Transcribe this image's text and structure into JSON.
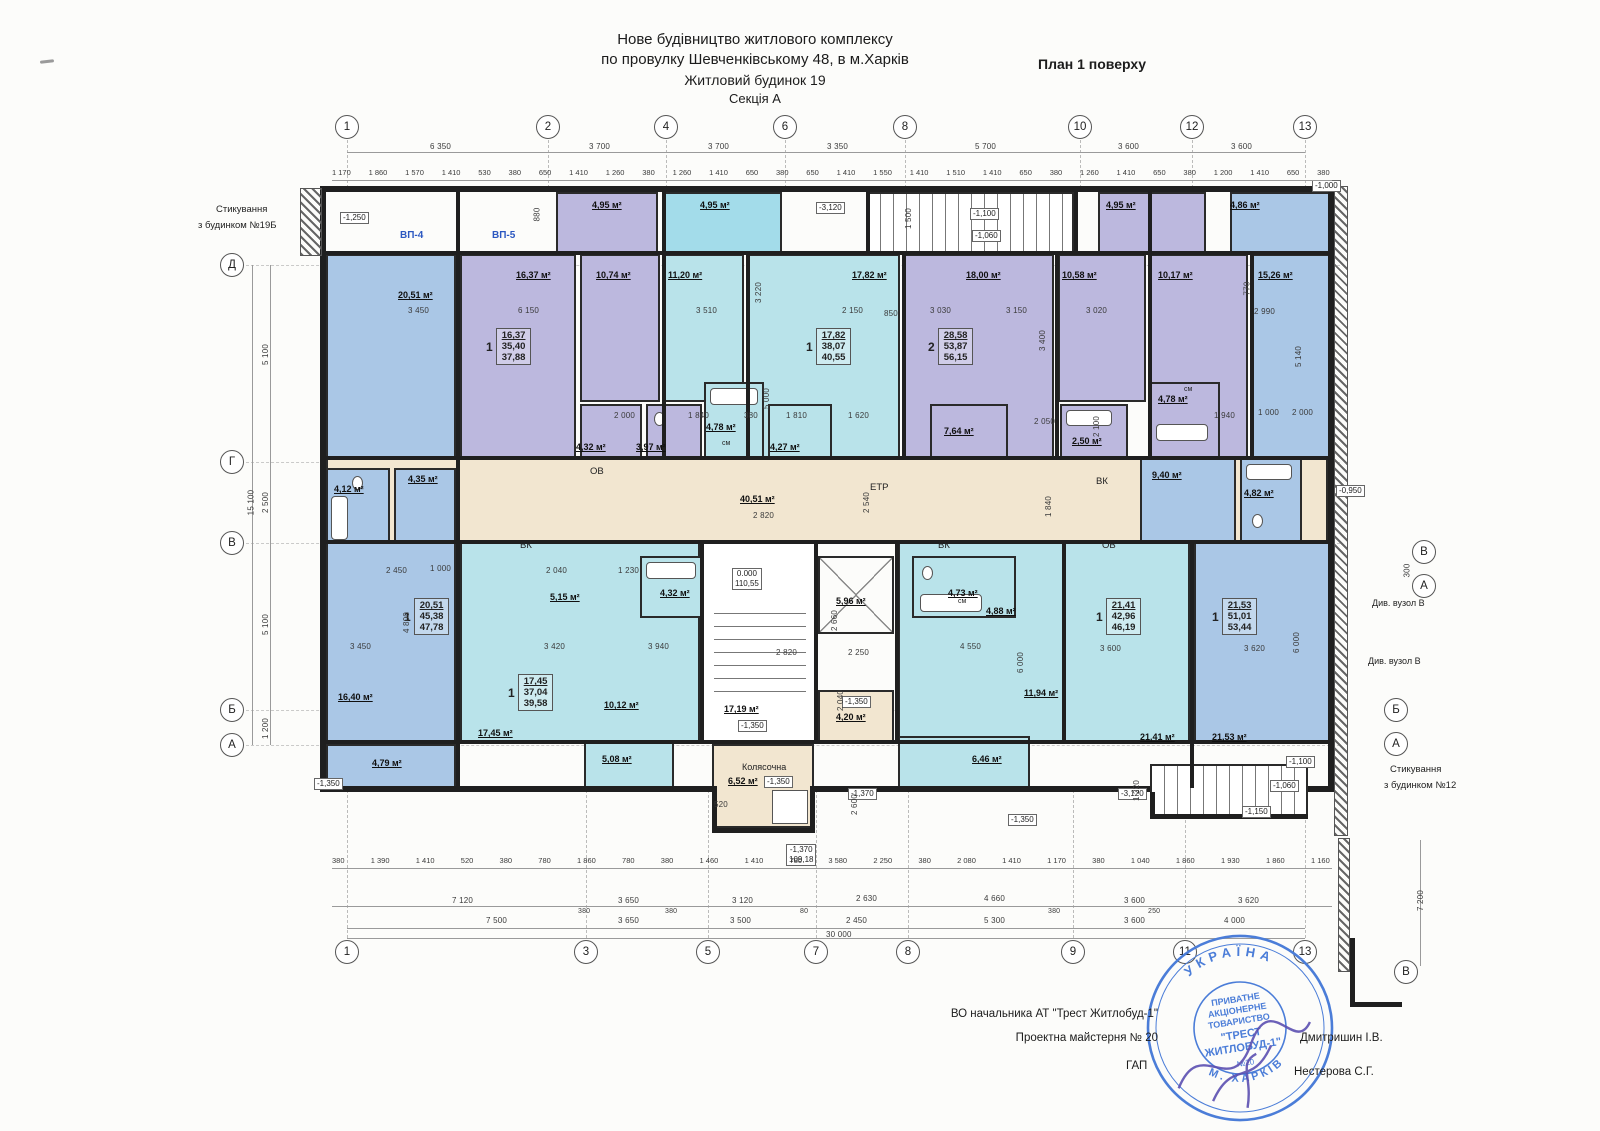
{
  "header": {
    "t1": "Нове будівництво житлового комплексу",
    "t2": "по провулку Шевченківському 48, в м.Харків",
    "t3": "Житловий будинок 19",
    "t4": "Секція  А",
    "plan": "План 1 поверху"
  },
  "axes": {
    "top": [
      "1",
      "2",
      "4",
      "6",
      "8",
      "10",
      "12",
      "13"
    ],
    "bottom": [
      "1",
      "3",
      "5",
      "7",
      "8",
      "9",
      "11",
      "13"
    ],
    "left": [
      "Д",
      "Г",
      "В",
      "Б",
      "А"
    ],
    "right": [
      "В",
      "А",
      "Б",
      "А",
      "В"
    ]
  },
  "rooms": [
    "4,95 м²",
    "4,95 м²",
    "4,95 м²",
    "4,86 м²",
    "20,51 м²",
    "16,37 м²",
    "10,74 м²",
    "11,20 м²",
    "17,82 м²",
    "18,00 м²",
    "10,58 м²",
    "10,17 м²",
    "15,26 м²",
    "4,32 м²",
    "3,97 м²",
    "4,78 м²",
    "4,27 м²",
    "7,64 м²",
    "2,50 м²",
    "4,78 м²",
    "40,51 м²",
    "4,12 м²",
    "4,35 м²",
    "9,40 м²",
    "4,82 м²",
    "16,40 м²",
    "5,15 м²",
    "4,32 м²",
    "17,45 м²",
    "10,12 м²",
    "17,19 м²",
    "5,96 м²",
    "4,20 м²",
    "4,73 м²",
    "4,88 м²",
    "11,94 м²",
    "21,41 м²",
    "21,53 м²",
    "4,79 м²",
    "5,08 м²",
    "6,46 м²",
    "6,52 м²"
  ],
  "apartments": [
    {
      "count": "1",
      "a": "16,37",
      "b": "35,40",
      "c": "37,88"
    },
    {
      "count": "1",
      "a": "17,82",
      "b": "38,07",
      "c": "40,55"
    },
    {
      "count": "2",
      "a": "28,58",
      "b": "53,87",
      "c": "56,15"
    },
    {
      "count": "1",
      "a": "20,51",
      "b": "45,38",
      "c": "47,78"
    },
    {
      "count": "1",
      "a": "17,45",
      "b": "37,04",
      "c": "39,58"
    },
    {
      "count": "1",
      "a": "21,41",
      "b": "42,96",
      "c": "46,19"
    },
    {
      "count": "1",
      "a": "21,53",
      "b": "51,01",
      "c": "53,44"
    }
  ],
  "elevations": [
    "-1,250",
    "-3,120",
    "-1,100",
    "-1,060",
    "-1,000",
    "-0,950",
    "-1,350",
    "-1,350",
    "-1,350",
    "-1,350",
    "-1,350",
    "-1,370",
    "-3,120",
    "-1,100",
    "-1,060",
    "-1,150"
  ],
  "levels": {
    "zero": "0.000",
    "zero_abs": "110,55",
    "low": "-1,370",
    "low_abs": "109,18"
  },
  "dims": {
    "top_segments": [
      "6 350",
      "3 700",
      "3 700",
      "3 350",
      "5 700",
      "3 600",
      "3 600"
    ],
    "top_details": [
      "1 170",
      "1 860",
      "1 570",
      "1 410",
      "530",
      "380",
      "650",
      "1 410",
      "1 260",
      "380",
      "1 260",
      "1 410",
      "650",
      "380",
      "650",
      "1 410",
      "1 550",
      "1 410",
      "1 510",
      "1 410",
      "650",
      "380",
      "1 260",
      "1 410",
      "650",
      "380",
      "1 200",
      "1 410",
      "650",
      "380"
    ],
    "bottom_details": [
      "380",
      "1 390",
      "1 410",
      "520",
      "380",
      "780",
      "1 860",
      "780",
      "380",
      "1 460",
      "1 410",
      "780",
      "3 580",
      "2 250",
      "380",
      "2 080",
      "1 410",
      "1 170",
      "380",
      "1 040",
      "1 860",
      "1 930",
      "1 860",
      "1 160"
    ],
    "bottom_mid": [
      "7 120",
      "3 650",
      "3 120",
      "2 630",
      "4 660",
      "3 600",
      "3 620",
      "380",
      "380",
      "380",
      "250"
    ],
    "bottom_main": [
      "7 500",
      "3 650",
      "3 500",
      "2 450",
      "5 300",
      "3 600",
      "4 000",
      "80"
    ],
    "total": "30 000",
    "left": [
      "5 100",
      "2 500",
      "5 100",
      "1 200",
      "15 100"
    ],
    "right": [
      "7 200",
      "300"
    ],
    "floating": [
      "3 450",
      "6 150",
      "3 510",
      "2 150",
      "850",
      "3 030",
      "3 150",
      "3 020",
      "2 990",
      "5 140",
      "5 000",
      "3 400",
      "3 220",
      "2 000",
      "1 840",
      "380",
      "1 810",
      "1 620",
      "2 050",
      "2 100",
      "1 940",
      "1 000",
      "2 000",
      "2 820",
      "2 540",
      "1 840",
      "2 450",
      "1 000",
      "2 040",
      "1 230",
      "3 420",
      "3 940",
      "3 450",
      "4 800",
      "2 820",
      "2 250",
      "2 660",
      "4 550",
      "3 600",
      "3 620",
      "6 000",
      "6 000",
      "1 500",
      "880",
      "770",
      "520",
      "2 600",
      "2 040",
      "1 220"
    ]
  },
  "notes": {
    "vp4": "ВП-4",
    "vp5": "ВП-5",
    "join_left1": "Стикування",
    "join_left2": "з будинком №19Б",
    "join_right1": "Стикування",
    "join_right2": "з будинком №12",
    "detail_node": "Див. вузол В",
    "kolyasochna": "Колясочна",
    "etr": "ЕТР",
    "vk": "ВК",
    "ov": "ОВ",
    "sm": "см"
  },
  "footer": {
    "l1": "ВО начальника АТ \"Трест Житлобуд-1\"",
    "l2": "Проектна майстерня № 20",
    "gap": "ГАП",
    "sig1": "Дмитришин І.В.",
    "sig2": "Нестерова С.Г."
  },
  "stamp": {
    "top": "УКРАЇНА",
    "bottom": "М. ХАРКІВ",
    "l1": "ПРИВАТНЕ",
    "l2": "АКЦІОНЕРНЕ",
    "l3": "ТОВАРИСТВО",
    "l4": "\"ТРЕСТ",
    "l5": "ЖИТЛОБУД-1\"",
    "num": "№20"
  },
  "colors": {
    "blue_room": "#aac7e6",
    "purple_room": "#bcb8de",
    "cyan_room": "#b9e3ea",
    "corridor": "#f2e6d0",
    "stamp_blue": "#4b7dd8",
    "note_blue": "#2b57c0"
  }
}
